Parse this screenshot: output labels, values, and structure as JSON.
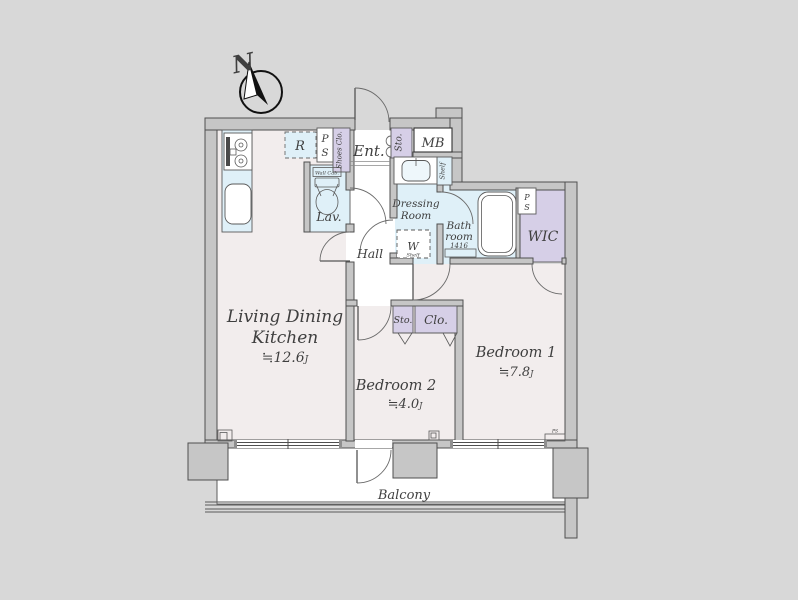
{
  "colors": {
    "background": "#d8d8d8",
    "wall_fill": "#c6c6c6",
    "wall_stroke": "#4f4f4f",
    "floor": "#f2eded",
    "wet_area": "#dff0f8",
    "closet": "#d6cfe7",
    "white": "#ffffff",
    "text": "#3f3f3f"
  },
  "compass": {
    "north_label": "N"
  },
  "rooms": {
    "ldk": {
      "line1": "Living Dining",
      "line2": "Kitchen",
      "size": "≒12.6",
      "unit": "J"
    },
    "bedroom1": {
      "name": "Bedroom 1",
      "size": "≒7.8",
      "unit": "J"
    },
    "bedroom2": {
      "name": "Bedroom 2",
      "size": "≒4.0",
      "unit": "J"
    },
    "hall": {
      "name": "Hall"
    },
    "entrance": {
      "name": "Ent."
    },
    "lavatory": {
      "name": "Lav.",
      "wall_cabinet": "Wall Cab."
    },
    "dressing_room": {
      "line1": "Dressing",
      "line2": "Room",
      "shelf": "Shelf",
      "washer": "W",
      "washer_shelf": "Shelf"
    },
    "bathroom": {
      "line1": "Bath",
      "line2": "room",
      "size_code": "1416"
    },
    "wic": {
      "name": "WIC"
    },
    "balcony": {
      "name": "Balcony"
    }
  },
  "storage": {
    "shoes_closet": "Shoes Clo.",
    "entrance_storage": "Sto.",
    "hall_storage": "Sto.",
    "bedroom_closet": "Clo."
  },
  "fixtures": {
    "meter_box": "MB",
    "refrigerator": "R",
    "pipe_space_top": {
      "p": "P",
      "s": "S"
    },
    "pipe_space_wic": {
      "p": "P",
      "s": "S"
    },
    "pipe_space_small": "PS"
  }
}
